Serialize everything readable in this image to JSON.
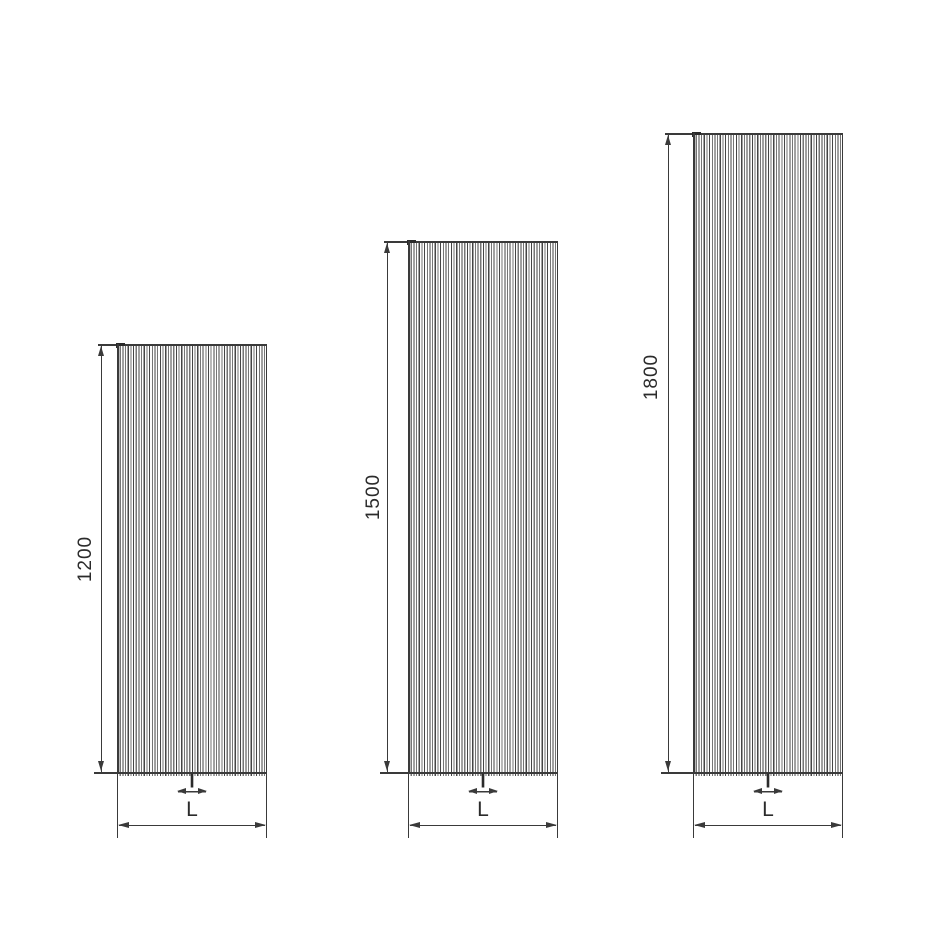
{
  "figure": {
    "background_color": "#ffffff",
    "line_color": "#3a3a3a",
    "text_color": "#2b2b2b"
  },
  "panels": [
    {
      "height_mm": 1200,
      "height_label": "1200",
      "width_label": "L",
      "fin_label": "l"
    },
    {
      "height_mm": 1500,
      "height_label": "1500",
      "width_label": "L",
      "fin_label": "l"
    },
    {
      "height_mm": 1800,
      "height_label": "1800",
      "width_label": "L",
      "fin_label": "l"
    }
  ]
}
